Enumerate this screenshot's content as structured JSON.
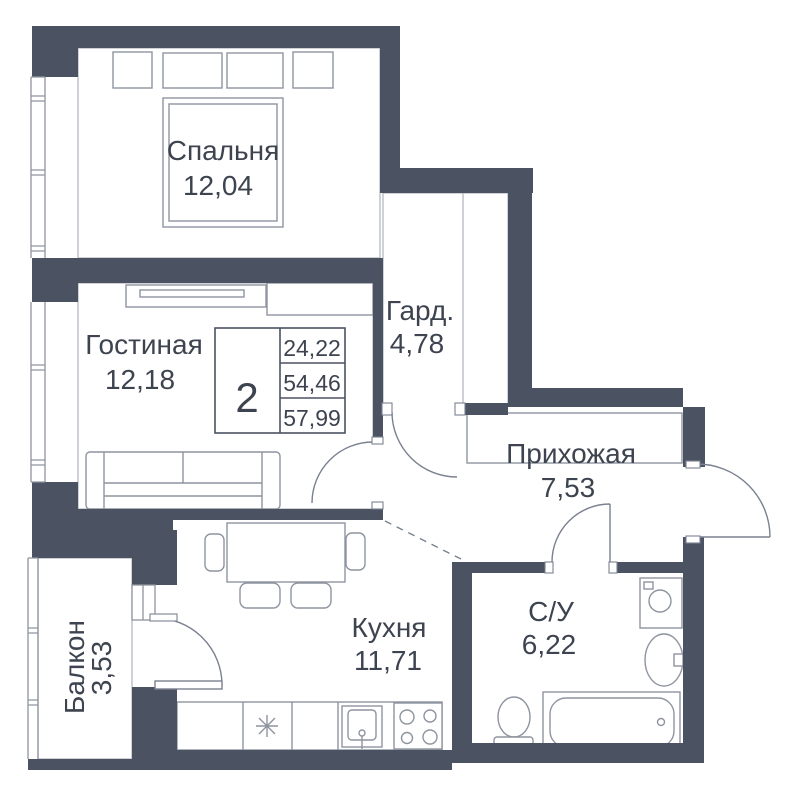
{
  "plan": {
    "stats": {
      "rooms_count": "2",
      "areas": [
        "24,22",
        "54,46",
        "57,99"
      ]
    },
    "rooms": [
      {
        "id": "bedroom",
        "name": "Спальня",
        "area": "12,04"
      },
      {
        "id": "living",
        "name": "Гостиная",
        "area": "12,18"
      },
      {
        "id": "wardrobe",
        "name": "Гард.",
        "area": "4,78"
      },
      {
        "id": "hallway",
        "name": "Прихожая",
        "area": "7,53"
      },
      {
        "id": "kitchen",
        "name": "Кухня",
        "area": "11,71"
      },
      {
        "id": "bathroom",
        "name": "С/У",
        "area": "6,22"
      },
      {
        "id": "balcony",
        "name": "Балкон",
        "area": "3,53"
      }
    ],
    "colors": {
      "wall": "#4b5262",
      "text": "#3d4450",
      "furniture": "#8e949f",
      "outline": "#b4b8c0",
      "door": "#7a8190"
    }
  }
}
